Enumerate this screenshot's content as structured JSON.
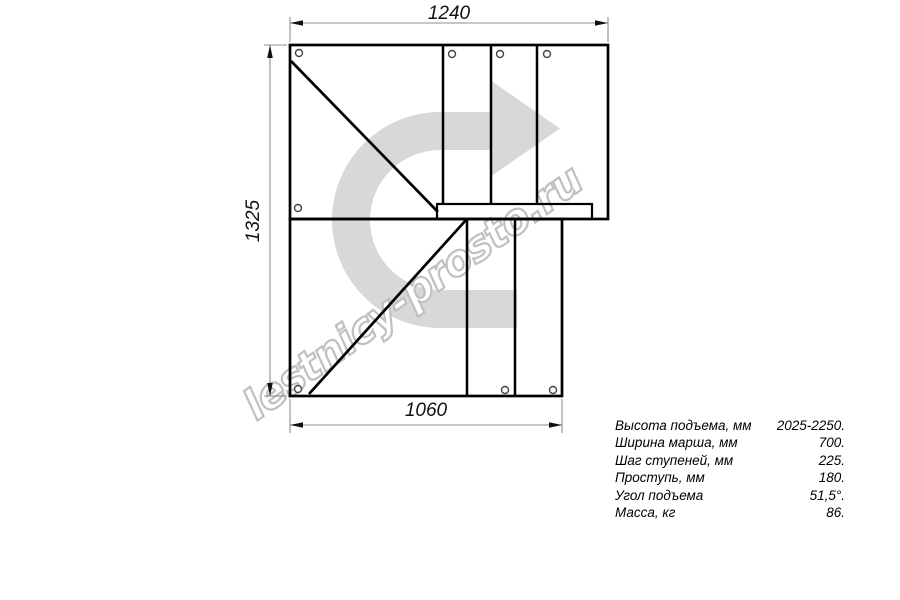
{
  "diagram": {
    "type": "staircase-plan-top-view",
    "dimensions": {
      "top_mm": "1240",
      "left_mm": "1325",
      "bottom_mm": "1060"
    }
  },
  "specs": [
    {
      "label": "Высота подъема, мм",
      "value": "2025-2250."
    },
    {
      "label": "Ширина марша, мм",
      "value": "700."
    },
    {
      "label": "Шаг ступеней, мм",
      "value": "225."
    },
    {
      "label": "Проступь, мм",
      "value": "180."
    },
    {
      "label": "Угол подъема",
      "value": "51,5°."
    },
    {
      "label": "Масса, кг",
      "value": "86."
    }
  ],
  "watermark": {
    "text": "lestnicy-prosto.ru",
    "arrow_fill": "#d8d8d8",
    "text_fill": "#ffffff",
    "text_outline": "#c0c0c0"
  },
  "colors": {
    "background": "#ffffff",
    "drawing_line": "#000000",
    "dimension_line": "#8f8f8f",
    "dimension_text": "#111111"
  }
}
